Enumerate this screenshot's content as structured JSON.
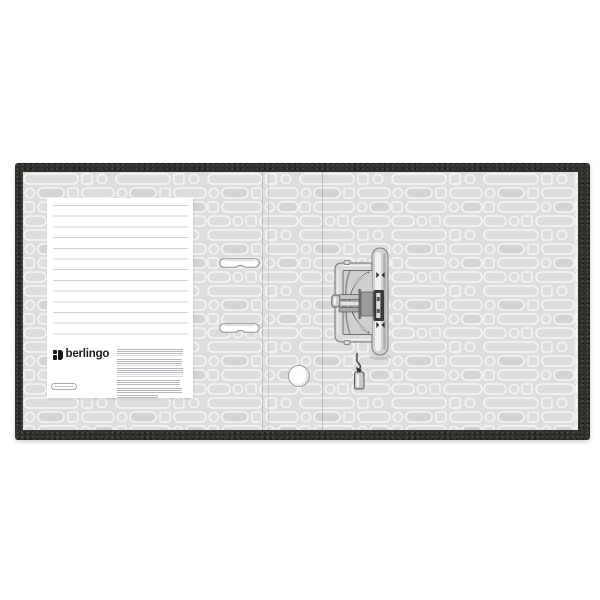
{
  "page": {
    "background": "#ffffff"
  },
  "product": {
    "name": "lever-arch-file-binder-open-inside-view",
    "brand": "berlingo"
  },
  "colors": {
    "edge_fabric": "#312f2c",
    "inner_cover": "#dcdddd",
    "pattern_stroke": "#f6f6f6",
    "pattern_fill_alt": "#d2d3d3",
    "sheet": "#ffffff",
    "ruled_line": "#cdd0d6",
    "logo": "#151515",
    "metal_light": "#efefef",
    "metal_mid": "#c9c9c9",
    "metal_dark": "#5a5a5a"
  },
  "label_sheet": {
    "logo_text": "berlingo",
    "ruled_line_count": 13,
    "micro_text_paragraphs": 6,
    "info_badge_has_micro_text": true
  },
  "hardware": {
    "clip_count": 2,
    "finger_hole_count": 1,
    "mechanism": "lever-arch-mechanism-side-view"
  }
}
